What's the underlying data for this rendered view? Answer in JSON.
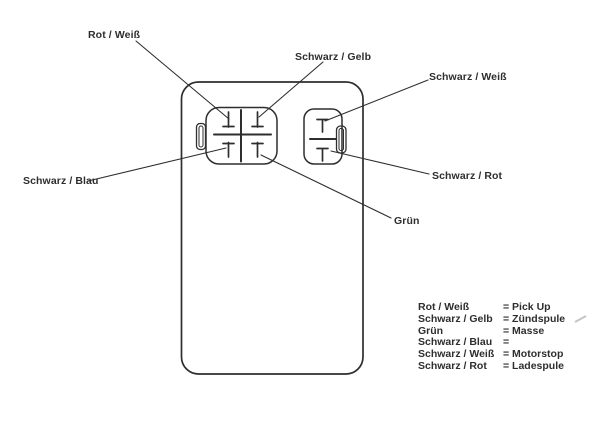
{
  "page": {
    "paper_color": "#ffffff",
    "ink_color": "#2e2e2e"
  },
  "wire_labels": {
    "rot_weiss": "Rot / Weiß",
    "schwarz_gelb": "Schwarz / Gelb",
    "schwarz_weiss": "Schwarz / Weiß",
    "schwarz_blau": "Schwarz / Blau",
    "gruen": "Grün",
    "schwarz_rot": "Schwarz / Rot"
  },
  "legend": {
    "rows": [
      {
        "term": "Rot / Weiß",
        "value": "= Pick Up"
      },
      {
        "term": "Schwarz / Gelb",
        "value": "= Zündspule"
      },
      {
        "term": "Grün",
        "value": "= Masse"
      },
      {
        "term": "Schwarz / Blau",
        "value": "="
      },
      {
        "term": "Schwarz / Weiß",
        "value": "= Motorstop"
      },
      {
        "term": "Schwarz / Rot",
        "value": "= Ladespule"
      }
    ]
  }
}
